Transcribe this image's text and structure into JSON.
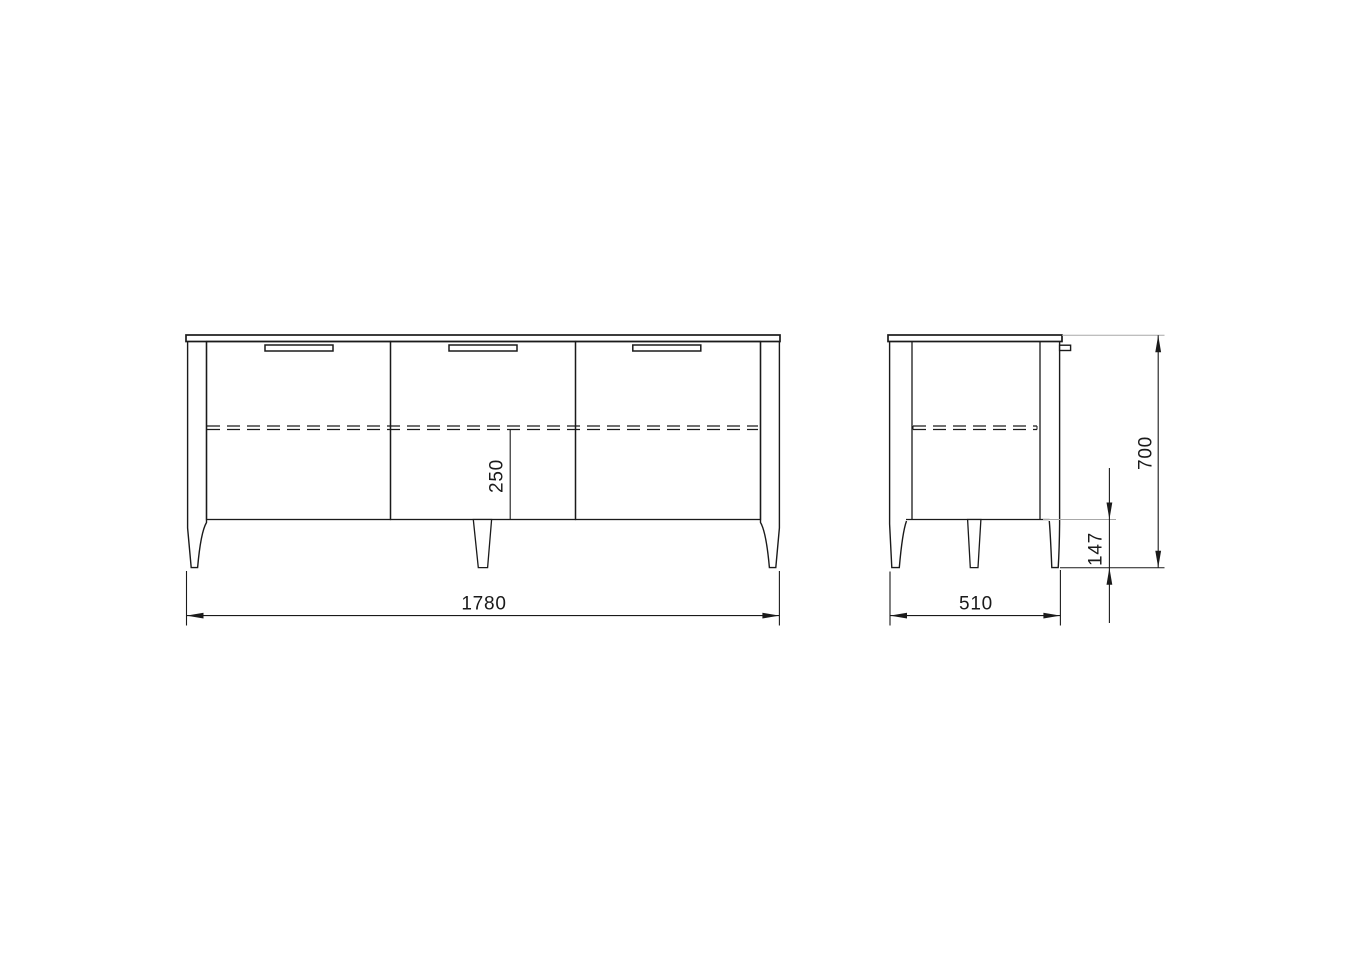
{
  "drawing": {
    "kind": "cabinet orthographic technical drawing",
    "views": {
      "front": {
        "doors": 3,
        "handles": 3,
        "legs_visible": 3
      },
      "side": {
        "legs_visible": 3
      }
    }
  },
  "dimensions": {
    "front_width": {
      "value": "1780",
      "orientation": "horizontal"
    },
    "shelf_drop": {
      "value": "250",
      "orientation": "vertical"
    },
    "side_depth": {
      "value": "510",
      "orientation": "horizontal"
    },
    "total_height": {
      "value": "700",
      "orientation": "vertical"
    },
    "leg_height": {
      "value": "147",
      "orientation": "vertical"
    }
  },
  "colors": {
    "line": "#1a1a1a",
    "extension_line_gray": "#a8a8a8",
    "background": "#ffffff"
  }
}
